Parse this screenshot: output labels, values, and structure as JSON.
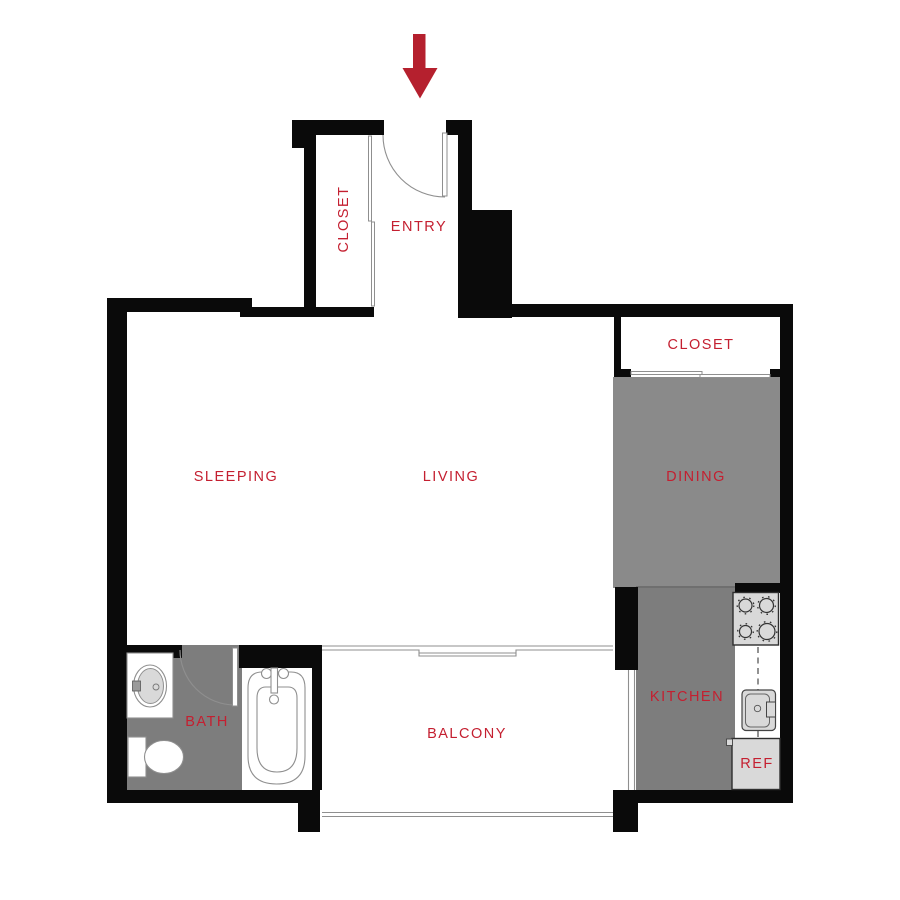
{
  "palette": {
    "wall": "#0a0a0a",
    "floor": "#7d7d7d",
    "floor_dining": "#8a8a8a",
    "fixture_fill": "#d9d9d9",
    "fixture_border": "#2e2e2e",
    "thin_line": "#8f8f8f",
    "label": "#c41f30",
    "arrow": "#b5202e"
  },
  "labels": {
    "entry_closet": "CLOSET",
    "entry": "ENTRY",
    "hall_closet": "CLOSET",
    "sleeping": "SLEEPING",
    "living": "LIVING",
    "dining": "DINING",
    "bath": "BATH",
    "balcony": "BALCONY",
    "kitchen": "KITCHEN",
    "refrigerator": "REF"
  },
  "icons": {
    "entry_arrow": "down-arrow",
    "fixtures": [
      "entry-door",
      "closet-sliding-door",
      "hall-closet-sliding-door",
      "bath-door",
      "bathroom-sink",
      "toilet",
      "bathtub",
      "balcony-sliding-door",
      "balcony-railing",
      "kitchen-window",
      "stove",
      "kitchen-sink",
      "refrigerator",
      "counter-dashed-line"
    ]
  }
}
